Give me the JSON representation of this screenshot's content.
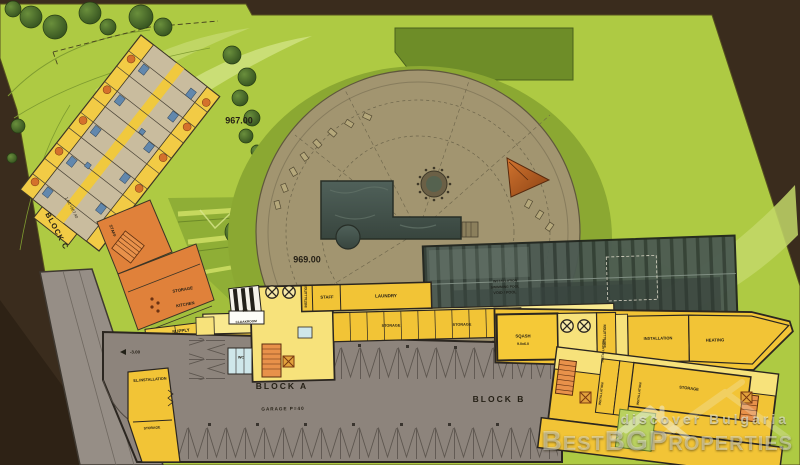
{
  "site": {
    "blocks": {
      "a": "BLOCK A",
      "b": "BLOCK B",
      "c": "BLOCK C"
    },
    "levels": {
      "upper": "967.00",
      "terrace": "969.00",
      "garage": "-3.00",
      "block_c_dim": "1.60 +967.40"
    },
    "garage_label": "GARAGE P=40",
    "rooms": {
      "staff": "STAFF",
      "laundry": "LAUNDRY",
      "storage": "STORAGE",
      "kitchen_line1": "STORAGE",
      "kitchen_line2": "KITCHEN",
      "supply": "SUPPLY",
      "cloakroom_line1": "SKI-",
      "cloakroom_line2": "CLOAKROOM",
      "wc": "WC",
      "installation": "INSTALLATION",
      "el_installation": "EL.INSTALLATION",
      "heating": "HEATING",
      "squash": "SQASH",
      "squash_dim": "9.0x6.0",
      "pool_line1": "INSTALLATION",
      "pool_line2": "SWIMMING POOL",
      "pool_line3": "VOID / POOL"
    }
  },
  "watermark": {
    "tagline": "discover Bulgaria",
    "brand": "BestBGProperties"
  },
  "palette": {
    "lawn": "#aeca43",
    "lawn_light": "#cde07c",
    "lawn_dark": "#6e8d28",
    "earth": "#3a2c1d",
    "terrace": "#a29570",
    "pool_water": "#45534b",
    "room_yellow": "#f2c436",
    "room_pale": "#f7e27b",
    "room_orange": "#e0813a",
    "garage_gray": "#8d847c"
  }
}
